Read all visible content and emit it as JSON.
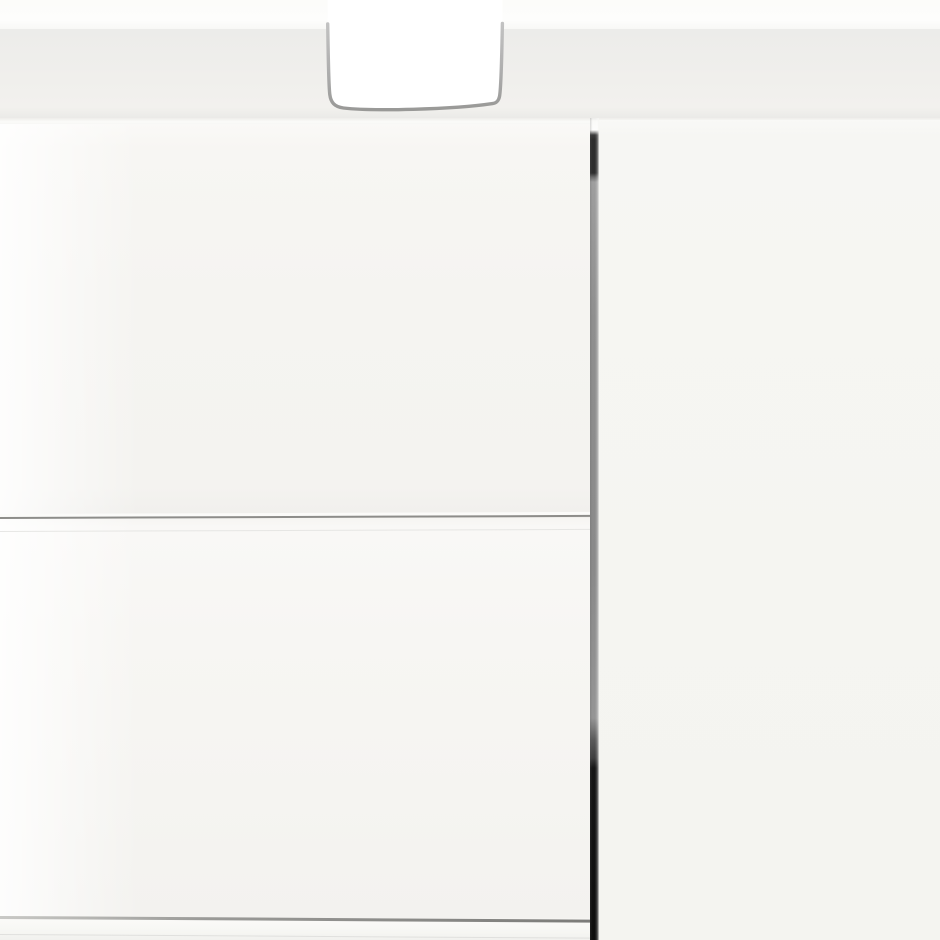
{
  "scene": {
    "type": "product-photo-closeup",
    "description": "Extreme close-up of a glossy white cabinet / sideboard. A light grey-white top surface runs across the upper part with a white wall strip above it. A U-shaped recessed handle cutout with grey metal trim is routed into the top edge. Below, two seamed glossy white drawer fronts occupy the left side, separated from a plain white door panel on the right by a narrow vertical gap whose shadow fades from grey at the top to black at the bottom. A second horizontal seam near the bottom marks the next drawer front.",
    "objects": [
      {
        "name": "wall-strip",
        "description": "white wall visible above the cabinet top"
      },
      {
        "name": "cabinet-top-surface",
        "description": "light grey-white top surface of the cabinet"
      },
      {
        "name": "cabinet-front-edge-highlight",
        "description": "bright front edge of the top surface"
      },
      {
        "name": "handle-cutout",
        "description": "U-shaped recessed handle cutout with grey metal trim, white interior"
      },
      {
        "name": "upper-drawer-front",
        "description": "glossy white upper drawer front, left of the gap"
      },
      {
        "name": "drawer-seam",
        "description": "thin grey horizontal seam between upper and lower drawer fronts"
      },
      {
        "name": "lower-drawer-front",
        "description": "glossy white lower drawer front"
      },
      {
        "name": "bottom-drawer-seam",
        "description": "grey horizontal seam above the bottom drawer front, slightly sloping down to the right"
      },
      {
        "name": "bottom-drawer-front-strip",
        "description": "top sliver of the next drawer front at the bottom edge"
      },
      {
        "name": "panel-gap-shadow",
        "description": "narrow vertical gap between left drawers and right door; white at the very top, dark grey segment, long medium grey run, then solid black toward the bottom"
      },
      {
        "name": "right-door-panel",
        "description": "plain uniform white door panel filling the right side"
      },
      {
        "name": "gloss-reflection",
        "description": "soft bright vertical reflection along the left edge of the drawer fronts"
      }
    ]
  },
  "colors": {
    "wall": "#fcfcfa",
    "top_surface": "#efeeeb",
    "top_surface_dark": "#e9e9e6",
    "edge_highlight": "#fbfbf9",
    "face": "#f5f4f1",
    "face_bright": "#fbfbf9",
    "right_panel": "#f5f5f1",
    "seam": "#8d8d8a",
    "seam_echo": "#e3e3e0",
    "bottom_seam": "#7c7c79",
    "bottom_seam_light": "#c9c9c6",
    "trim_light": "#c2c2c2",
    "trim_dark": "#999997",
    "interior": "#ffffff",
    "gap_gray": "#8f8f8f",
    "gap_dark_top": "#2e2e2e",
    "gap_black": "#0e0e0e",
    "gap_wedge": "#fafaf8"
  }
}
